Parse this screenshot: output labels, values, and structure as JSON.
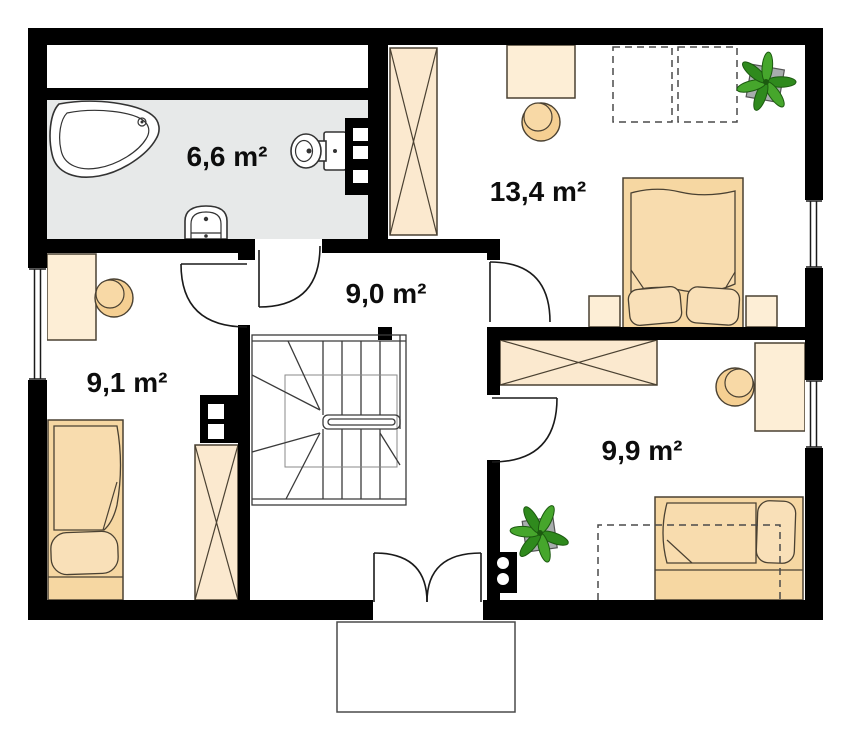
{
  "rooms": [
    {
      "name": "bathroom",
      "area": "6,6 m²"
    },
    {
      "name": "bedroom-large",
      "area": "13,4 m²"
    },
    {
      "name": "hall",
      "area": "9,0 m²"
    },
    {
      "name": "bedroom-left",
      "area": "9,1 m²"
    },
    {
      "name": "bedroom-right",
      "area": "9,9 m²"
    }
  ],
  "fixtures": {
    "bathroom": [
      "bathtub",
      "toilet",
      "washbasin",
      "installation-shaft"
    ],
    "bedroom-large": [
      "wardrobe",
      "desk",
      "chair",
      "double-bed",
      "nightstand",
      "nightstand",
      "plant",
      "roof-window-dashed",
      "roof-window-dashed",
      "window"
    ],
    "hall": [
      "staircase",
      "double-balcony-door"
    ],
    "bedroom-left": [
      "desk",
      "chair",
      "single-bed",
      "wardrobe",
      "installation-shaft",
      "window"
    ],
    "bedroom-right": [
      "wardrobe",
      "desk",
      "chair",
      "single-bed",
      "plant",
      "installation-shaft",
      "window"
    ]
  },
  "colors": {
    "wall": "#000000",
    "bath_floor": "#e7e9e9",
    "desk_fill": "#fdeed6",
    "wardrobe_fill": "#fbe9cf",
    "bed_fill": "#f6d7a2",
    "blanket_fill": "#f8dcae",
    "pillow_fill": "#f9e0b8",
    "chair_fill": "#f5cf92",
    "chair_top": "#f8d9a6",
    "outline": "#4a4132",
    "door_line": "#1a1a1a",
    "stair_line": "#3a3a3a",
    "plant_green_dark": "#2f8a1d",
    "plant_green_light": "#46a62c",
    "pot_gray": "#a8adad",
    "label_text": "#0d0d0d"
  }
}
